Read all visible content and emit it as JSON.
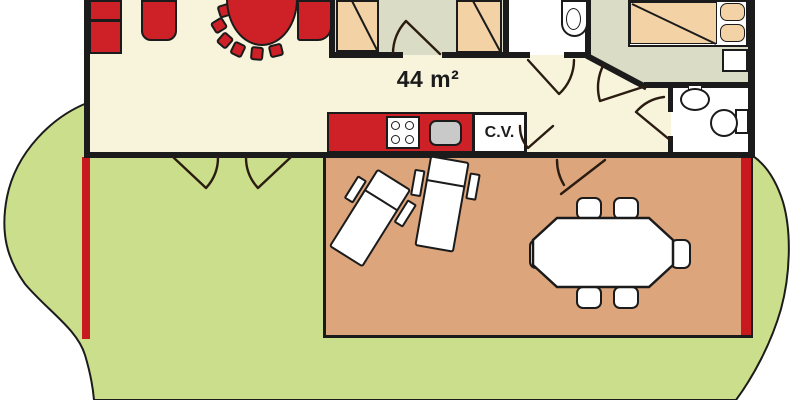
{
  "labels": {
    "area": "44 m²",
    "central_heating": "C.V."
  },
  "colors": {
    "background": "#FFFFFF",
    "grass": "#CBDE8B",
    "outline": "#1B1B1B",
    "door_line": "#2A1C10",
    "floor_cream": "#F8F4DB",
    "floor_green": "#DADCC5",
    "floor_white": "#FFFFFF",
    "bed_tan": "#F3D3A6",
    "terrace_tan": "#DCA57C",
    "furniture_red": "#CE2127",
    "boundary_red": "#C8191F",
    "sink_gray": "#C9C9C9"
  }
}
